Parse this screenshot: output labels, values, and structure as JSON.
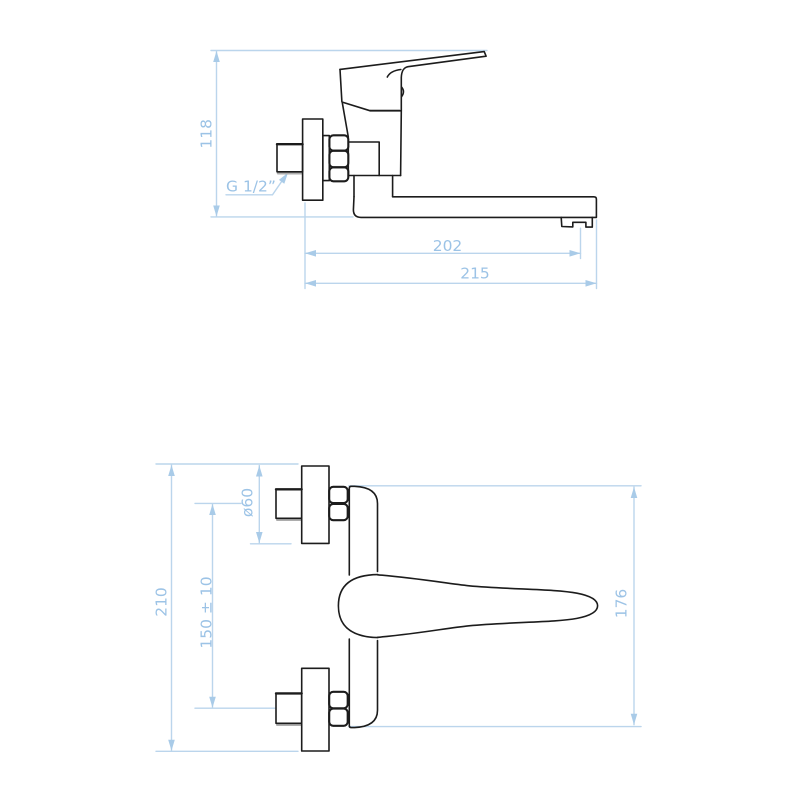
{
  "drawing_title": "Wall-mounted single-lever mixer tap — dimensional drawing, side view and plan view",
  "colors": {
    "background": "#ffffff",
    "outline": "#1c1c1c",
    "dimension_line": "#bbd5ec",
    "dimension_text": "#9cc3e6",
    "shadow": "#adadad"
  },
  "side_view": {
    "height_label": "118",
    "thread_label": "G 1/2”",
    "spout_reach_label": "202",
    "overall_length_label": "215"
  },
  "plan_view": {
    "overall_height_label": "210",
    "mount_spacing_label": "150 ± 10",
    "plate_diameter_label": "ø60",
    "body_span_label": "176"
  }
}
